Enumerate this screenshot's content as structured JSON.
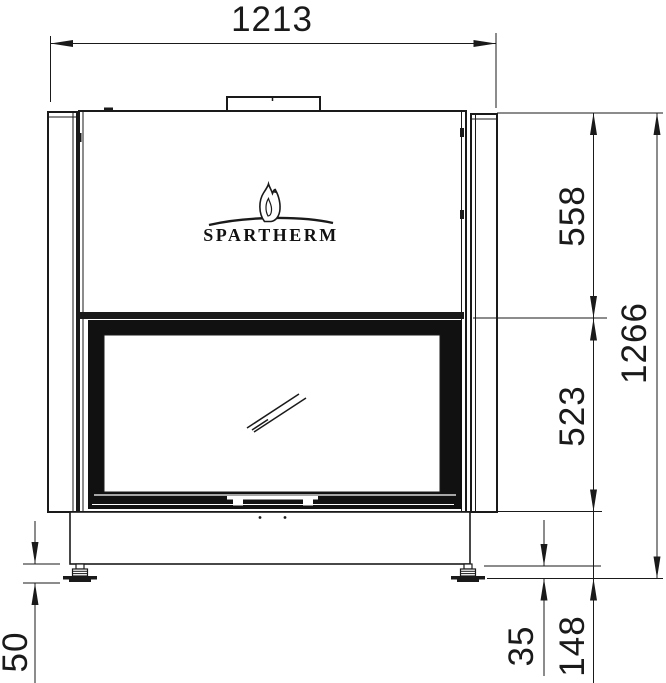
{
  "drawing": {
    "title": "Fireplace insert front view technical drawing",
    "brand": "SPARTHERM",
    "dimensions": {
      "top_width": "1213",
      "upper_section_height": "558",
      "door_section_height": "523",
      "total_height": "1266",
      "foot_adjustment": "50",
      "foot_height": "35",
      "base_section_height": "148"
    },
    "colors": {
      "line": "#1a1a1a",
      "background": "#ffffff"
    }
  }
}
